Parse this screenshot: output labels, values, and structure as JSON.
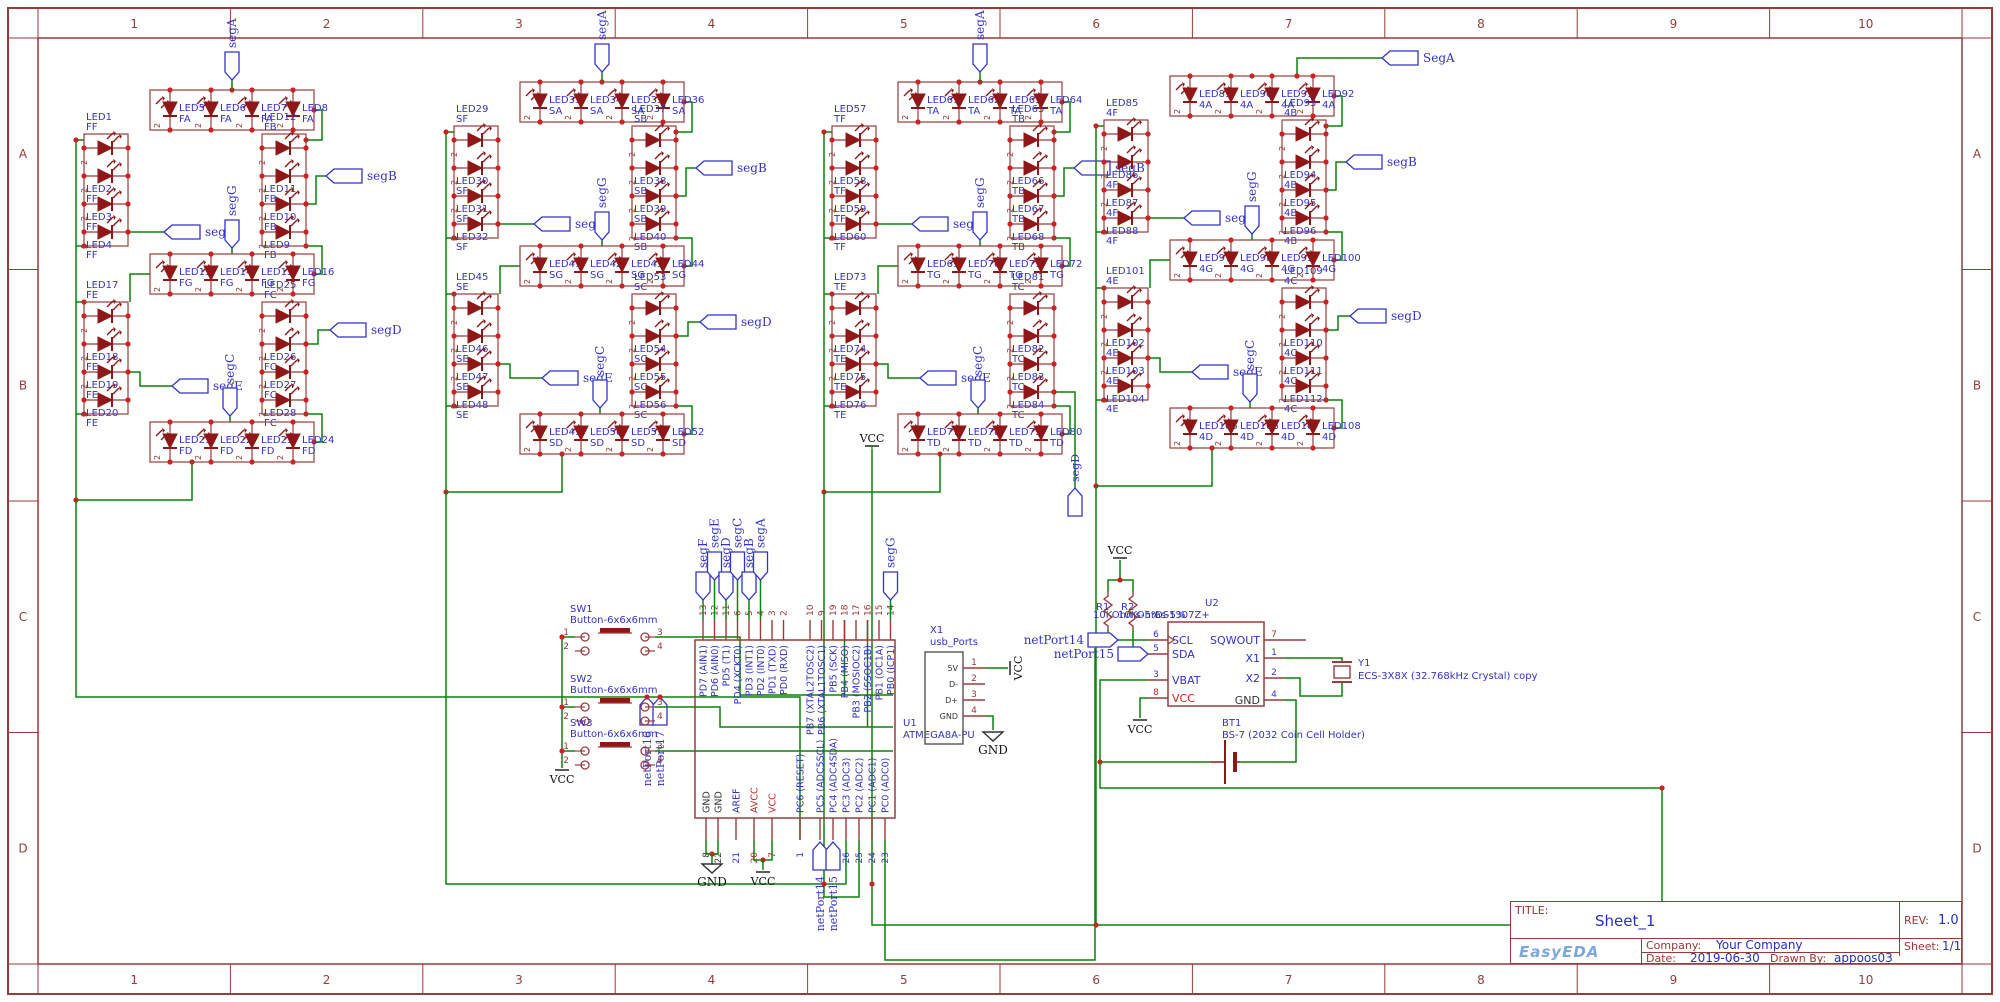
{
  "colors": {
    "wire": "#0a840a",
    "outline": "#9a3b3b",
    "diode": "#8f1717",
    "label": "#3232cc",
    "dot": "#cc2222",
    "frame": "#983a3a",
    "pin_num": "#9b3535",
    "red_text": "#cc2222",
    "black": "#222222"
  },
  "frame": {
    "columns": [
      "1",
      "2",
      "3",
      "4",
      "5",
      "6",
      "7",
      "8",
      "9",
      "10"
    ],
    "rows": [
      "A",
      "B",
      "C",
      "D"
    ]
  },
  "title_block": {
    "title_label": "TITLE:",
    "title": "Sheet_1",
    "rev_label": "REV:",
    "rev": "1.0",
    "company_label": "Company:",
    "company": "Your Company",
    "sheet_label": "Sheet:",
    "sheet": "1/1",
    "date_label": "Date:",
    "date": "2019-06-30",
    "drawn_label": "Drawn By:",
    "drawn_by": "appoos03",
    "logo": "EasyEDA"
  },
  "power": {
    "vcc": "VCC",
    "gnd": "GND"
  },
  "net_ports": [
    "netPort14",
    "netPort15",
    "netPort16",
    "netPort17"
  ],
  "digits": [
    {
      "id": "digit-1",
      "flags": {
        "a": "segA",
        "f": "segF",
        "b": "segB",
        "g": "segG",
        "e": "segE",
        "c": "segC",
        "d": "segD"
      },
      "segments": [
        {
          "code": "A",
          "tag": "FA",
          "leds": [
            "LED5",
            "LED6",
            "LED7",
            "LED8"
          ]
        },
        {
          "code": "F",
          "tag": "FF",
          "leds": [
            "LED1",
            "LED2",
            "LED3",
            "LED4"
          ]
        },
        {
          "code": "B",
          "tag": "FB",
          "leds": [
            "LED12",
            "LED11",
            "LED10",
            "LED9"
          ]
        },
        {
          "code": "G",
          "tag": "FG",
          "leds": [
            "LED13",
            "LED14",
            "LED15",
            "LED16"
          ]
        },
        {
          "code": "E",
          "tag": "FE",
          "leds": [
            "LED17",
            "LED18",
            "LED19",
            "LED20"
          ]
        },
        {
          "code": "C",
          "tag": "FC",
          "leds": [
            "LED25",
            "LED26",
            "LED27",
            "LED28"
          ]
        },
        {
          "code": "D",
          "tag": "FD",
          "leds": [
            "LED21",
            "LED22",
            "LED23",
            "LED24"
          ]
        }
      ]
    },
    {
      "id": "digit-2",
      "flags": {
        "a": "segA",
        "f": "segF",
        "b": "segB",
        "g": "segG",
        "e": "segE",
        "c": "segC",
        "d": "segD"
      },
      "segments": [
        {
          "code": "A",
          "tag": "SA",
          "leds": [
            "LED33",
            "LED34",
            "LED35",
            "LED36"
          ]
        },
        {
          "code": "F",
          "tag": "SF",
          "leds": [
            "LED29",
            "LED30",
            "LED31",
            "LED32"
          ]
        },
        {
          "code": "B",
          "tag": "SB",
          "leds": [
            "LED37",
            "LED38",
            "LED39",
            "LED40"
          ]
        },
        {
          "code": "G",
          "tag": "SG",
          "leds": [
            "LED41",
            "LED42",
            "LED43",
            "LED44"
          ]
        },
        {
          "code": "E",
          "tag": "SE",
          "leds": [
            "LED45",
            "LED46",
            "LED47",
            "LED48"
          ]
        },
        {
          "code": "C",
          "tag": "SC",
          "leds": [
            "LED53",
            "LED54",
            "LED55",
            "LED56"
          ]
        },
        {
          "code": "D",
          "tag": "SD",
          "leds": [
            "LED49",
            "LED50",
            "LED51",
            "LED52"
          ]
        }
      ]
    },
    {
      "id": "digit-3",
      "flags": {
        "a": "segA",
        "f": "segF",
        "b": "segB",
        "g": "segG",
        "e": "segE",
        "c": "segC",
        "d": "segD"
      },
      "segments": [
        {
          "code": "A",
          "tag": "TA",
          "leds": [
            "LED61",
            "LED62",
            "LED63",
            "LED64"
          ]
        },
        {
          "code": "F",
          "tag": "TF",
          "leds": [
            "LED57",
            "LED58",
            "LED59",
            "LED60"
          ]
        },
        {
          "code": "B",
          "tag": "TB",
          "leds": [
            "LED65",
            "LED66",
            "LED67",
            "LED68"
          ]
        },
        {
          "code": "G",
          "tag": "TG",
          "leds": [
            "LED69",
            "LED70",
            "LED71",
            "LED72"
          ]
        },
        {
          "code": "E",
          "tag": "TE",
          "leds": [
            "LED73",
            "LED74",
            "LED75",
            "LED76"
          ]
        },
        {
          "code": "C",
          "tag": "TC",
          "leds": [
            "LED81",
            "LED82",
            "LED83",
            "LED84"
          ]
        },
        {
          "code": "D",
          "tag": "TD",
          "leds": [
            "LED77",
            "LED78",
            "LED79",
            "LED80"
          ]
        }
      ]
    },
    {
      "id": "digit-4",
      "flags": {
        "a": "SegA",
        "f": "segF",
        "b": "segB",
        "g": "segG",
        "e": "segE",
        "c": "segC",
        "d": "segD"
      },
      "segments": [
        {
          "code": "A",
          "tag": "4A",
          "leds": [
            "LED89",
            "LED90",
            "LED91",
            "LED92"
          ]
        },
        {
          "code": "F",
          "tag": "4F",
          "leds": [
            "LED85",
            "LED86",
            "LED87",
            "LED88"
          ]
        },
        {
          "code": "B",
          "tag": "4B",
          "leds": [
            "LED93",
            "LED94",
            "LED95",
            "LED96"
          ]
        },
        {
          "code": "G",
          "tag": "4G",
          "leds": [
            "LED97",
            "LED98",
            "LED99",
            "LED100"
          ]
        },
        {
          "code": "E",
          "tag": "4E",
          "leds": [
            "LED101",
            "LED102",
            "LED103",
            "LED104"
          ]
        },
        {
          "code": "C",
          "tag": "4C",
          "leds": [
            "LED109",
            "LED110",
            "LED111",
            "LED112"
          ]
        },
        {
          "code": "D",
          "tag": "4D",
          "leds": [
            "LED105",
            "LED106",
            "LED107",
            "LED108"
          ]
        }
      ]
    }
  ],
  "buttons": [
    {
      "ref": "SW1",
      "value": "Button-6x6x6mm",
      "pins": [
        "1",
        "2",
        "3",
        "4"
      ]
    },
    {
      "ref": "SW2",
      "value": "Button-6x6x6mm",
      "pins": [
        "1",
        "2",
        "3",
        "4"
      ]
    },
    {
      "ref": "SW3",
      "value": "Button-6x6x6mm",
      "pins": [
        "1",
        "2",
        "3",
        "4"
      ]
    }
  ],
  "mcu": {
    "ref": "U1",
    "value": "ATMEGA8A-PU",
    "top_flags": [
      "segF",
      "segE",
      "segD",
      "segC",
      "segB",
      "segA",
      "segG"
    ],
    "top_pins": [
      {
        "num": "13",
        "name": "PD7 (AIN1)"
      },
      {
        "num": "12",
        "name": "PD6 (AIN0)"
      },
      {
        "num": "11",
        "name": "PD5 (T1)"
      },
      {
        "num": "6",
        "name": "PD4 (XCKT0)"
      },
      {
        "num": "5",
        "name": "PD3 (INT1)"
      },
      {
        "num": "4",
        "name": "PD2 (INT0)"
      },
      {
        "num": "3",
        "name": "PD1 (TXD)"
      },
      {
        "num": "2",
        "name": "PD0 (RXD)"
      },
      {
        "num": "10",
        "name": "PB7 (XTAL2TOSC2)"
      },
      {
        "num": "9",
        "name": "PB6 (XTAL1TOSC1)"
      },
      {
        "num": "19",
        "name": "PB5 (SCK)"
      },
      {
        "num": "18",
        "name": "PB4 (MISO)"
      },
      {
        "num": "17",
        "name": "PB3 (MOSIOC2)"
      },
      {
        "num": "16",
        "name": "PB2 (SSOC1B)"
      },
      {
        "num": "15",
        "name": "PB1 (OC1A)"
      },
      {
        "num": "14",
        "name": "PB0 (ICP1)"
      }
    ],
    "bottom_pins": [
      {
        "num": "8",
        "name": "GND",
        "nc": "k",
        "pc": "k"
      },
      {
        "num": "22",
        "name": "GND",
        "nc": "k",
        "pc": "k"
      },
      {
        "num": "21",
        "name": "AREF",
        "nc": "b",
        "pc": "b"
      },
      {
        "num": "20",
        "name": "AVCC",
        "nc": "r",
        "pc": "r"
      },
      {
        "num": "7",
        "name": "VCC",
        "nc": "r",
        "pc": "r"
      },
      {
        "num": "1",
        "name": "PC6 (RESET)",
        "nc": "b",
        "pc": "b"
      },
      {
        "num": "28",
        "name": "PC5 (ADC5SCL)",
        "nc": "b",
        "pc": "b"
      },
      {
        "num": "27",
        "name": "PC4 (ADC4SDA)",
        "nc": "b",
        "pc": "b"
      },
      {
        "num": "26",
        "name": "PC3 (ADC3)",
        "nc": "b",
        "pc": "b"
      },
      {
        "num": "25",
        "name": "PC2 (ADC2)",
        "nc": "b",
        "pc": "b"
      },
      {
        "num": "24",
        "name": "PC1 (ADC1)",
        "nc": "b",
        "pc": "b"
      },
      {
        "num": "23",
        "name": "PC0 (ADC0)",
        "nc": "b",
        "pc": "b"
      }
    ]
  },
  "usb": {
    "ref": "X1",
    "value": "usb_Ports",
    "pins": [
      {
        "num": "1",
        "name": "5V"
      },
      {
        "num": "2",
        "name": "D-"
      },
      {
        "num": "3",
        "name": "D+"
      },
      {
        "num": "4",
        "name": "GND"
      }
    ]
  },
  "rtc": {
    "ref": "U2",
    "value": "DS1307Z+",
    "left_pins": [
      {
        "num": "6",
        "name": "SCL",
        "nc": "b"
      },
      {
        "num": "5",
        "name": "SDA",
        "nc": "b"
      },
      {
        "num": "3",
        "name": "VBAT",
        "nc": "b"
      },
      {
        "num": "8",
        "name": "VCC",
        "nc": "r"
      }
    ],
    "right_pins": [
      {
        "num": "7",
        "name": "SQWOUT",
        "nc": "b"
      },
      {
        "num": "1",
        "name": "X1",
        "nc": "b"
      },
      {
        "num": "2",
        "name": "X2",
        "nc": "b"
      },
      {
        "num": "4",
        "name": "GND",
        "nc": "k"
      }
    ]
  },
  "resistors": [
    {
      "ref": "R1",
      "value": "10KOhms-5%"
    },
    {
      "ref": "R2",
      "value": "10KOhms-5%"
    }
  ],
  "crystal": {
    "ref": "Y1",
    "value": "ECS-3X8X (32.768kHz Crystal) copy"
  },
  "battery": {
    "ref": "BT1",
    "value": "BS-7 (2032 Coin Cell Holder)"
  }
}
